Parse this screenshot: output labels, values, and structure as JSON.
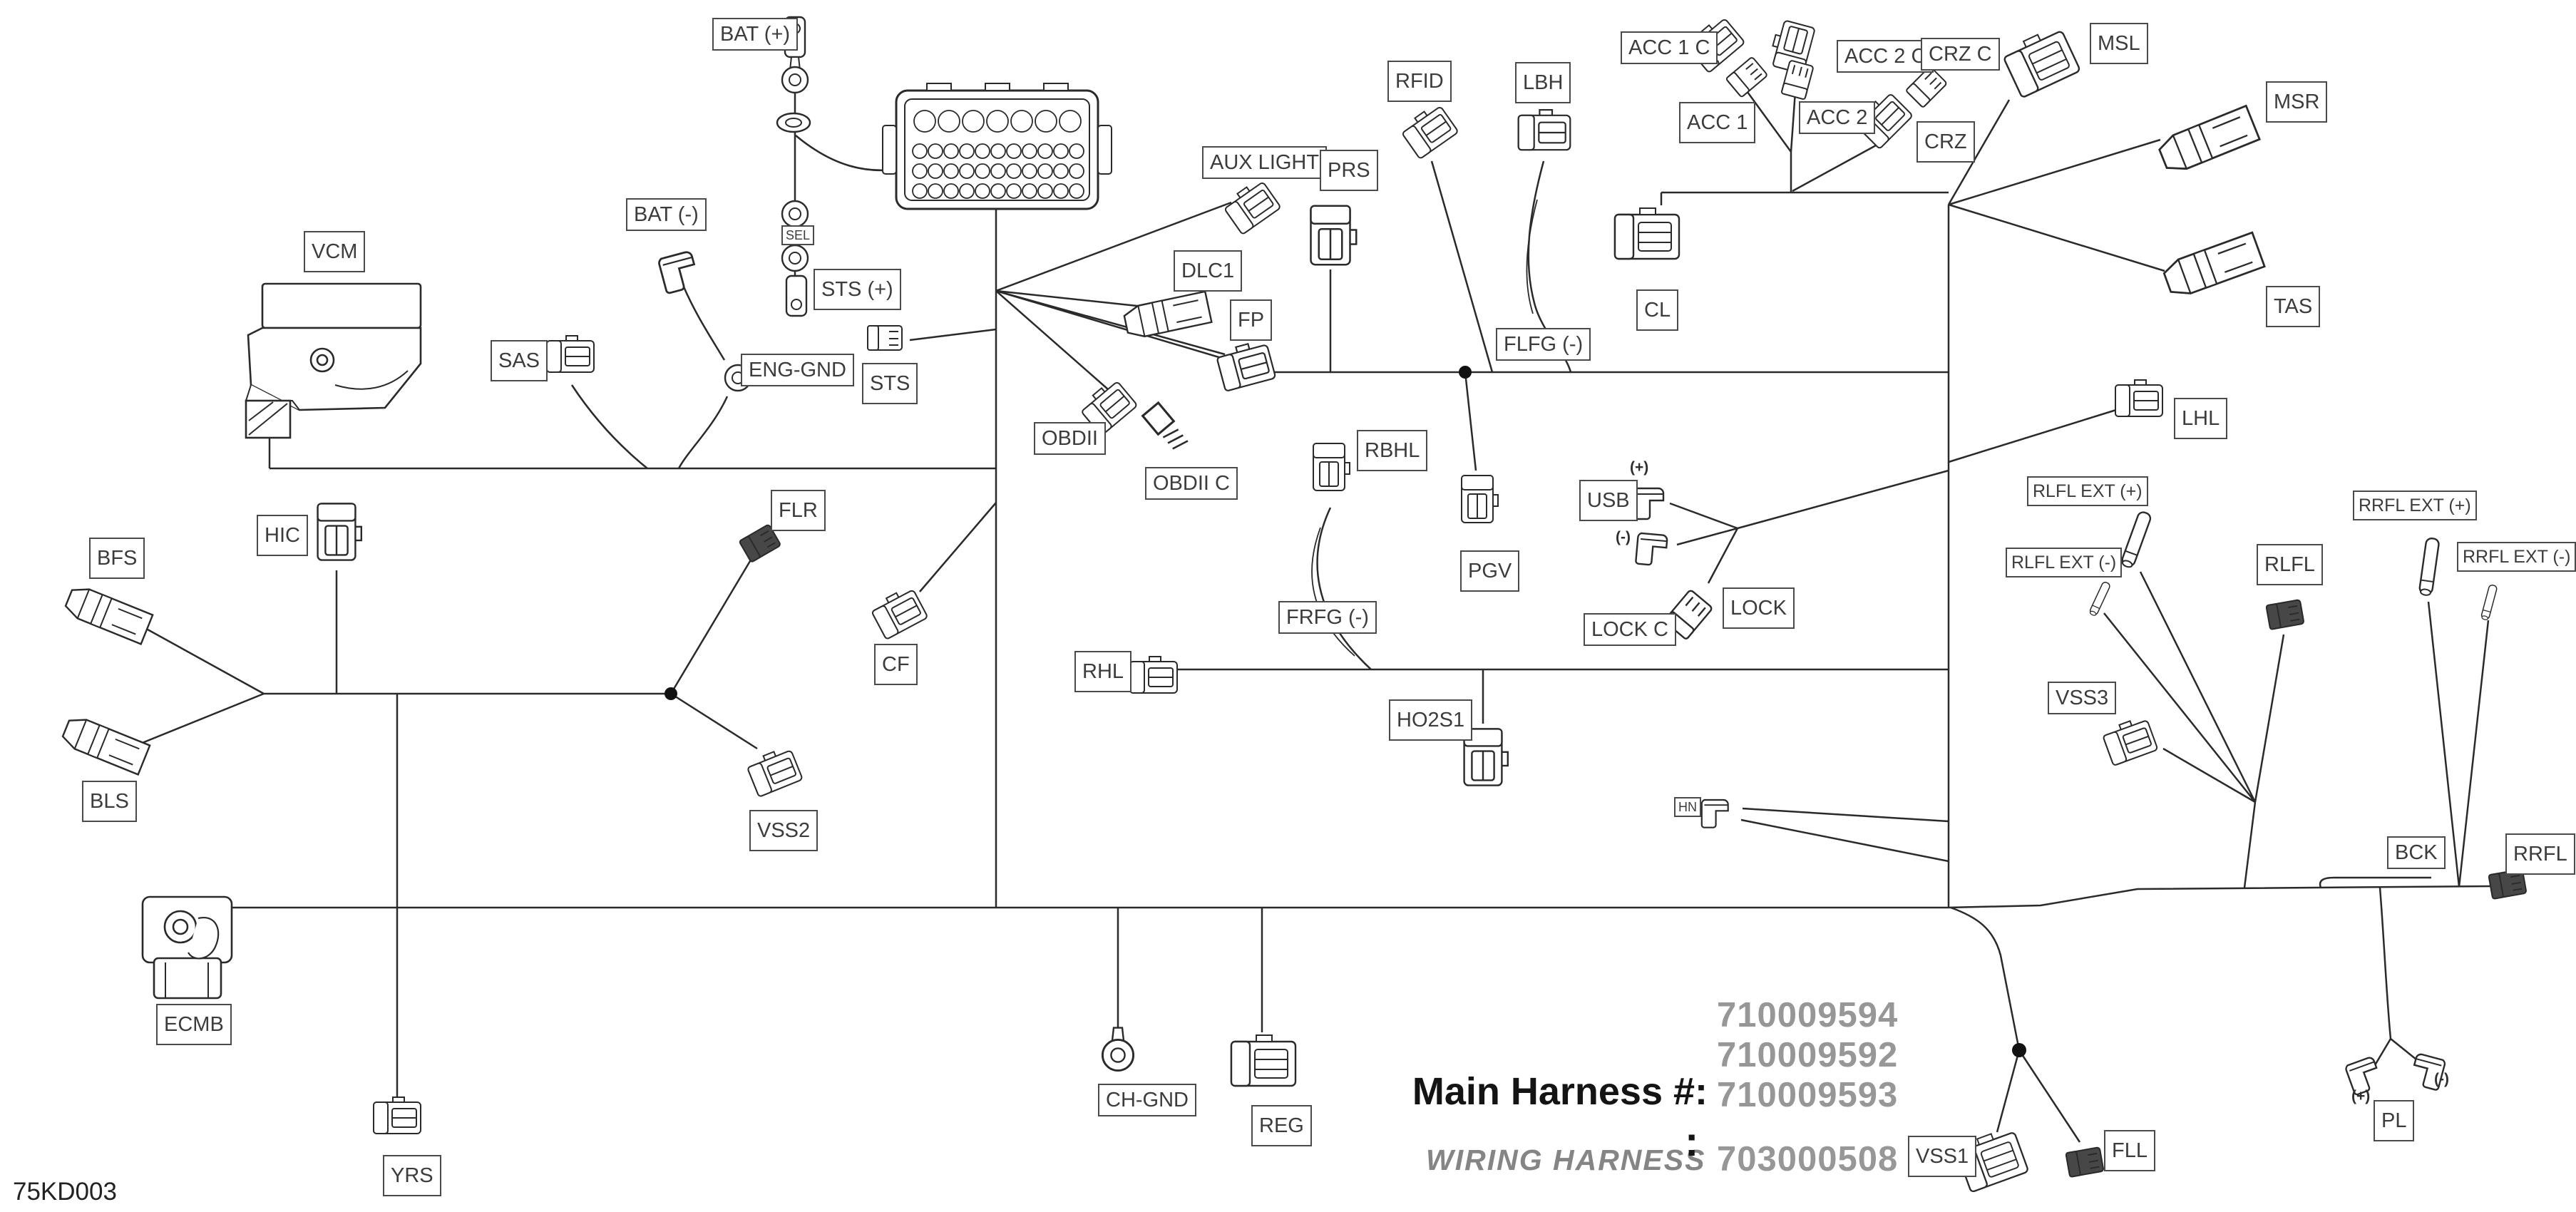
{
  "diagram": {
    "code": "75KD003",
    "harness_title": "Main Harness #:",
    "nums": {
      "n1": "710009594",
      "n2": "710009592",
      "n3": "710009593",
      "n4": "703000508"
    },
    "wiring_label": "WIRING HARNESS",
    "wiring_colon": ":"
  },
  "colors": {
    "line": "#2a2a2a",
    "label_border": "#4a4a4a",
    "label_text": "#3c3c3c",
    "number_gray": "#979797"
  },
  "labels": {
    "bat_plus": {
      "text": "BAT (+)"
    },
    "bat_minus": {
      "text": "BAT (-)"
    },
    "sts_plus": {
      "text": "STS (+)"
    },
    "eng_gnd": {
      "text": "ENG-GND"
    },
    "sts": {
      "text": "STS"
    },
    "vcm": {
      "text": "VCM"
    },
    "sas": {
      "text": "SAS"
    },
    "aux_light": {
      "text": "AUX LIGHT"
    },
    "prs": {
      "text": "PRS"
    },
    "dlc1": {
      "text": "DLC1"
    },
    "fp": {
      "text": "FP"
    },
    "obdii": {
      "text": "OBDII"
    },
    "obdii_c": {
      "text": "OBDII C"
    },
    "rbhl": {
      "text": "RBHL"
    },
    "pgv": {
      "text": "PGV"
    },
    "rfid": {
      "text": "RFID"
    },
    "lbh": {
      "text": "LBH"
    },
    "acc_1_c": {
      "text": "ACC 1 C"
    },
    "acc_1": {
      "text": "ACC 1"
    },
    "acc_2_c": {
      "text": "ACC 2 C"
    },
    "acc_2": {
      "text": "ACC 2"
    },
    "crz_c": {
      "text": "CRZ C"
    },
    "crz": {
      "text": "CRZ"
    },
    "msl": {
      "text": "MSL"
    },
    "msr": {
      "text": "MSR"
    },
    "tas": {
      "text": "TAS"
    },
    "cl": {
      "text": "CL"
    },
    "flfg": {
      "text": "FLFG (-)"
    },
    "usb": {
      "text": "USB"
    },
    "lock": {
      "text": "LOCK"
    },
    "lock_c": {
      "text": "LOCK C"
    },
    "lhl": {
      "text": "LHL"
    },
    "rlfl_ext_p": {
      "text": "RLFL EXT (+)"
    },
    "rlfl_ext_m": {
      "text": "RLFL EXT (-)"
    },
    "rlfl": {
      "text": "RLFL"
    },
    "rrfl_ext_p": {
      "text": "RRFL EXT (+)"
    },
    "rrfl_ext_m": {
      "text": "RRFL EXT (-)"
    },
    "vss3": {
      "text": "VSS3"
    },
    "bfs": {
      "text": "BFS"
    },
    "hic": {
      "text": "HIC"
    },
    "flr": {
      "text": "FLR"
    },
    "cf": {
      "text": "CF"
    },
    "rhl": {
      "text": "RHL"
    },
    "frfg": {
      "text": "FRFG (-)"
    },
    "ho2s1": {
      "text": "HO2S1"
    },
    "vss2": {
      "text": "VSS2"
    },
    "bls": {
      "text": "BLS"
    },
    "ecmb": {
      "text": "ECMB"
    },
    "yrs": {
      "text": "YRS"
    },
    "ch_gnd": {
      "text": "CH-GND"
    },
    "reg": {
      "text": "REG"
    },
    "vss1": {
      "text": "VSS1"
    },
    "fll": {
      "text": "FLL"
    },
    "bck": {
      "text": "BCK"
    },
    "rrfl": {
      "text": "RRFL"
    },
    "pl": {
      "text": "PL"
    },
    "hn": {
      "text": "HN"
    }
  },
  "tags": {
    "usb_plus": {
      "text": "(+)"
    },
    "usb_minus": {
      "text": "(-)"
    },
    "pl_plus": {
      "text": "(+)"
    },
    "pl_minus": {
      "text": "(-)"
    },
    "sel": {
      "text": "SEL"
    }
  }
}
